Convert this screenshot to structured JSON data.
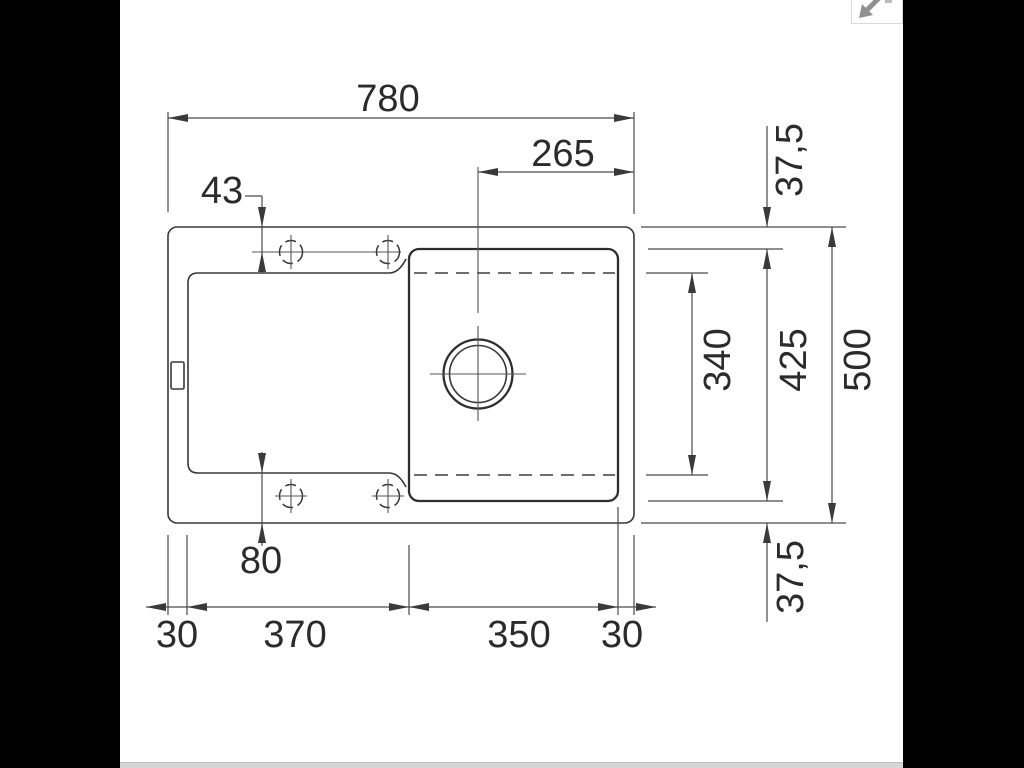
{
  "drawing": {
    "title": "sink-installation-dimension-drawing",
    "dims": {
      "overall_width": "780",
      "drain_to_right_edge": "265",
      "tap_holes_top_offset": "43",
      "tap_holes_bottom_offset": "80",
      "left_rim": "30",
      "drainboard_width": "370",
      "bowl_width": "350",
      "right_rim": "30",
      "rim_top": "37,5",
      "bowl_inner_length": "340",
      "bowl_outer_depth": "425",
      "overall_depth": "500",
      "rim_bottom": "37,5"
    }
  },
  "controls": {
    "collapse_icon": "arrow-down-left"
  },
  "colors": {
    "background": "#000000",
    "panel": "#ffffff",
    "object_line": "#383838",
    "dim_line": "#4a4a4a",
    "icon_gray": "#909090",
    "bottom_bar": "#d5d5d5"
  }
}
